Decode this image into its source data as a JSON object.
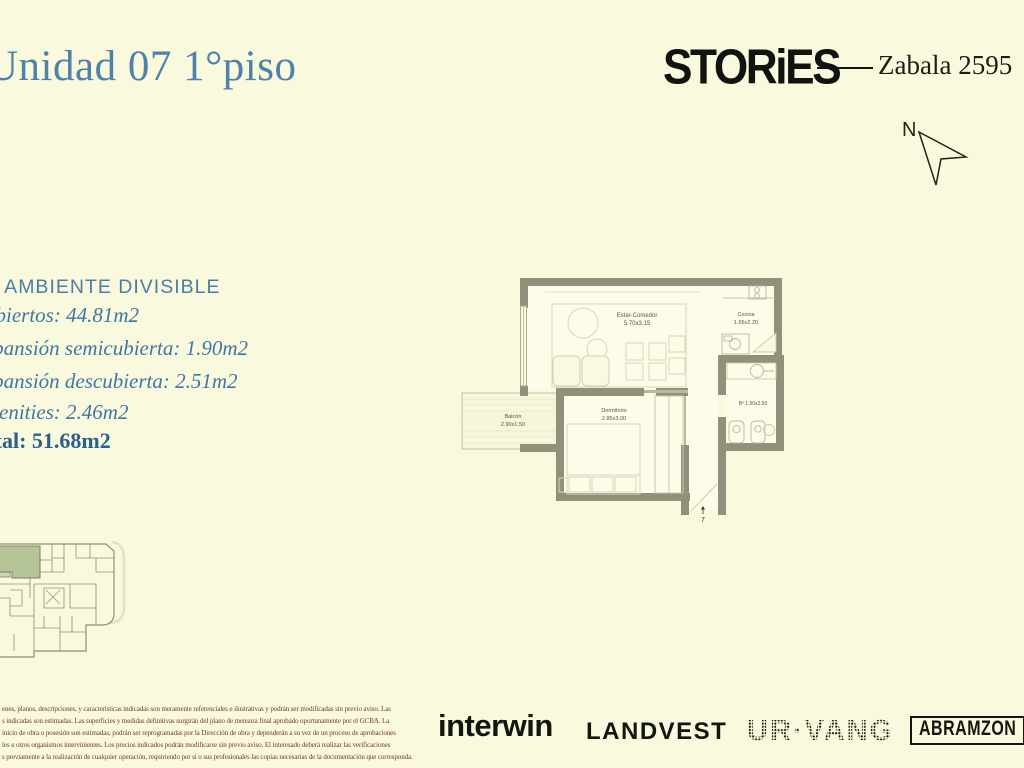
{
  "header": {
    "title": "Unidad 07 1°piso",
    "brand_logo": "STORiES",
    "address": "Zabala 2595",
    "compass_label": "N"
  },
  "unit_info": {
    "heading": "1 AMBIENTE DIVISIBLE",
    "area_lines": [
      "Cubiertos: 44.81m2",
      "Expansión semicubierta: 1.90m2",
      "Expansión descubierta: 2.51m2",
      "Amenities: 2.46m2"
    ],
    "total_line": "Total: 51.68m2"
  },
  "floor_plan": {
    "rooms": {
      "living": {
        "name": "Estar-Comedor",
        "size": "5.70x3.15"
      },
      "kitchen": {
        "name": "Cocina",
        "size": "1.65x2.20"
      },
      "balcony": {
        "name": "Balcón",
        "size": "2.90x1.50"
      },
      "bedroom": {
        "name": "Dormitorio",
        "size": "2.85x3.00"
      },
      "bathroom": {
        "label": "Bº 1.50x2.50"
      }
    },
    "entry_number": "7"
  },
  "footer": {
    "disclaimer_lines": [
      "enes, planos, descripciones, y características indicadas son meramente referenciales e ilustrativas y podrán ser modificadas sin previo aviso. Las",
      "s indicadas son estimadas. Las superficies y medidas definitivas surgirán del plano de mensura final aprobado oportunamente por el GCBA. La",
      "inicio de obra o posesión son estimadas, podrán ser reprogramadas por la Dirección de obra y dependerán a su vez de un proceso de aprobaciones",
      "les u otros organismos intervinientes. Los precios indicados podrán modificarse sin previo aviso. El interesado deberá realizar las verificaciones",
      "s previamente a la realización de cualquier operación, requiriendo por sí o sus profesionales las copias necesarias de la documentación que corresponda."
    ],
    "logos": {
      "interwin": "interwin",
      "landvest": "LANDVEST",
      "urvang": "UR·VANG",
      "abramzon": "ABRAMZON"
    }
  },
  "colors": {
    "background": "#f9f9dd",
    "title_blue": "#5081a9",
    "info_blue": "#3f77a4",
    "total_blue": "#2a5f8e",
    "wall_olive": "#90917b",
    "highlight_green": "#b5c497",
    "disclaimer_brown": "#6d382c",
    "logo_black": "#15150f"
  }
}
